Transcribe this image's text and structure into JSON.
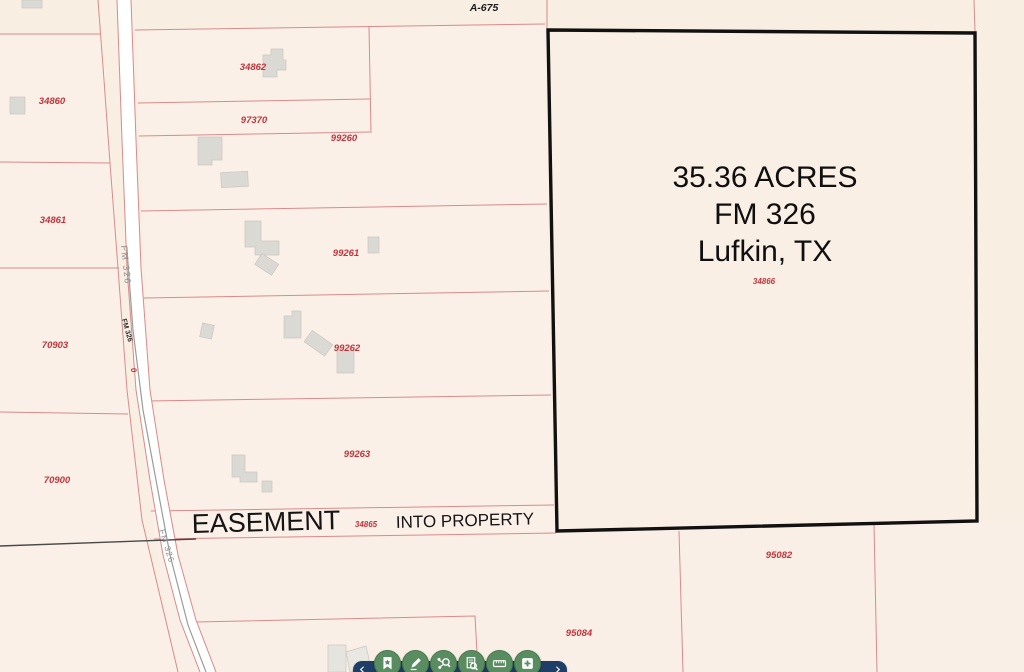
{
  "map": {
    "survey_label": "A-675",
    "road": {
      "label_upper": "FM 326",
      "label_mid": "FM 326",
      "label_lower": "FM 326",
      "marker": "0"
    },
    "parcels": {
      "34860": "34860",
      "34861": "34861",
      "34862": "34862",
      "97370": "97370",
      "99260": "99260",
      "99261": "99261",
      "99262": "99262",
      "99263": "99263",
      "70903": "70903",
      "70900": "70900",
      "95082": "95082",
      "95084": "95084"
    },
    "highlight": {
      "line1": "35.36 ACRES",
      "line2": "FM 326",
      "line3": "Lufkin, TX",
      "parcel_id": "34866"
    },
    "easement": {
      "title": "EASEMENT",
      "parcel_id": "34865",
      "subtitle": "INTO PROPERTY"
    },
    "colors": {
      "background": "#f8eee2",
      "parcel_fill": "#fbf0e8",
      "parcel_line": "#d98a8a",
      "parcel_id_text": "#c2343b",
      "highlight_outline": "#111111",
      "road_fill": "#ffffff",
      "building_fill": "#dbd9d3",
      "toolbar_bar": "#1e3e66",
      "toolbar_button": "#5a8c61"
    }
  },
  "toolbar": {
    "prev": "‹",
    "next": "›",
    "icons": [
      "bookmark-star-icon",
      "pencil-icon",
      "network-search-icon",
      "document-search-icon",
      "ruler-icon",
      "add-square-icon"
    ]
  }
}
